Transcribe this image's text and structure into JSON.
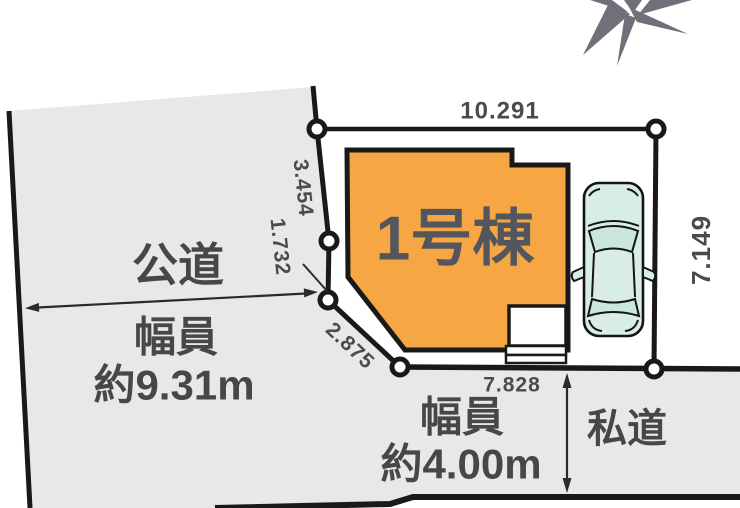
{
  "labels": {
    "building": "1号棟",
    "public_road": "公道",
    "public_road_width_line1": "幅員",
    "public_road_width_line2": "約9.31m",
    "private_road": "私道",
    "private_road_width_line1": "幅員",
    "private_road_width_line2": "約4.00m"
  },
  "dimensions": {
    "top": "10.291",
    "left_upper": "3.454",
    "left_lower": "1.732",
    "diagonal": "2.875",
    "bottom": "7.828",
    "right": "7.149"
  },
  "icons": {
    "compass": "north-compass-star",
    "car": "car-top-view"
  },
  "colors": {
    "building_fill": "#F6A743",
    "road_fill": "#E8E8E8",
    "car_fill": "#D9EDE7",
    "car_window_fill": "#CBE6DF",
    "outline": "#191919",
    "dimension_text": "#4B4B4B",
    "compass_gray": "#70707B"
  }
}
